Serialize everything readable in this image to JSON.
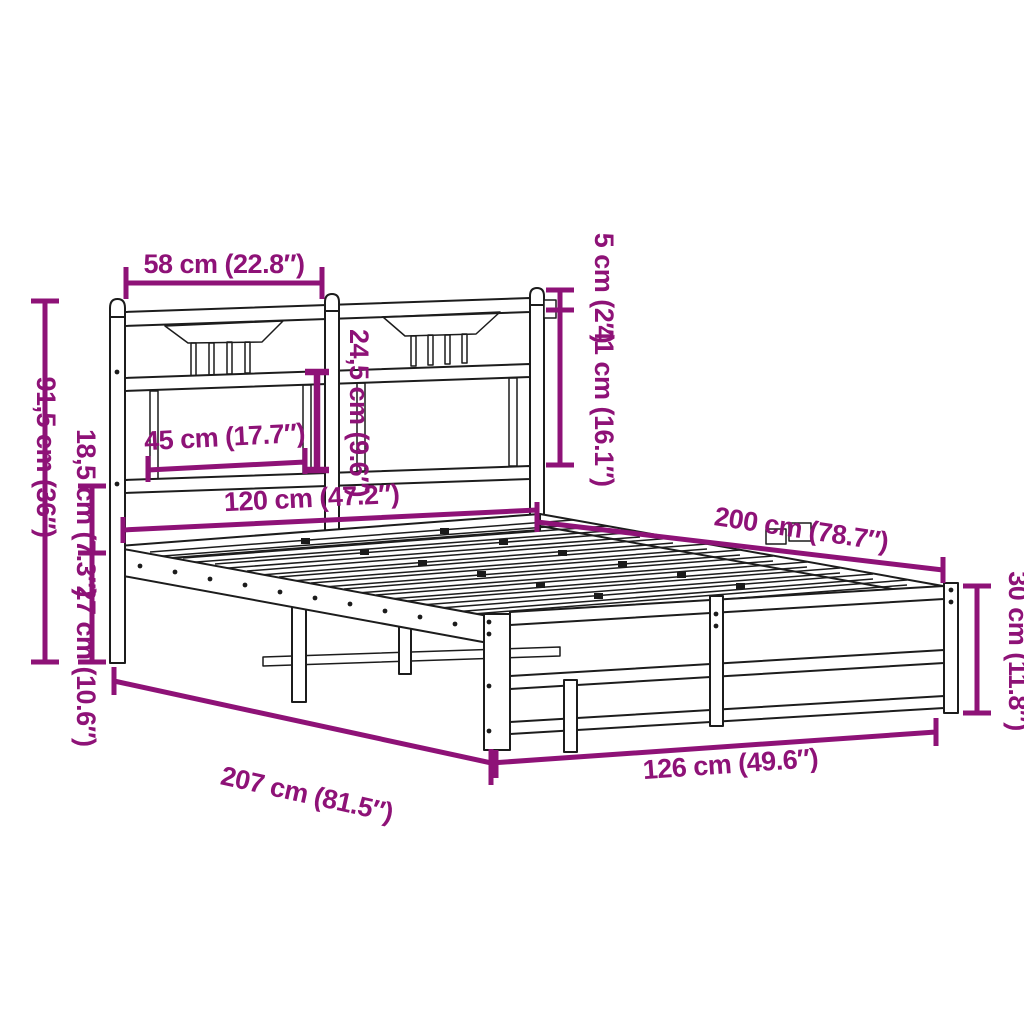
{
  "figure": {
    "style": {
      "dimension_color": "#8E1277",
      "drawing_color": "#1C1C1C",
      "background": "#FFFFFF"
    },
    "dimensions": {
      "headboard_section_width": "58 cm (22.8″)",
      "headboard_height": "91,5 cm (36″)",
      "headboard_bottom_gap": "18,5 cm (7.3″)",
      "leg_height": "27 cm (10.6″)",
      "post_cap_height": "5 cm (2″)",
      "headboard_upper_height": "41 cm (16.1″)",
      "headboard_panel_height": "24,5 cm (9.6″)",
      "headboard_panel_width": "45 cm (17.7″)",
      "bed_width": "120 cm (47.2″)",
      "bed_length": "200 cm (78.7″)",
      "total_length": "207 cm (81.5″)",
      "footboard_width": "126 cm (49.6″)",
      "footboard_height": "30 cm (11.8″)"
    }
  }
}
